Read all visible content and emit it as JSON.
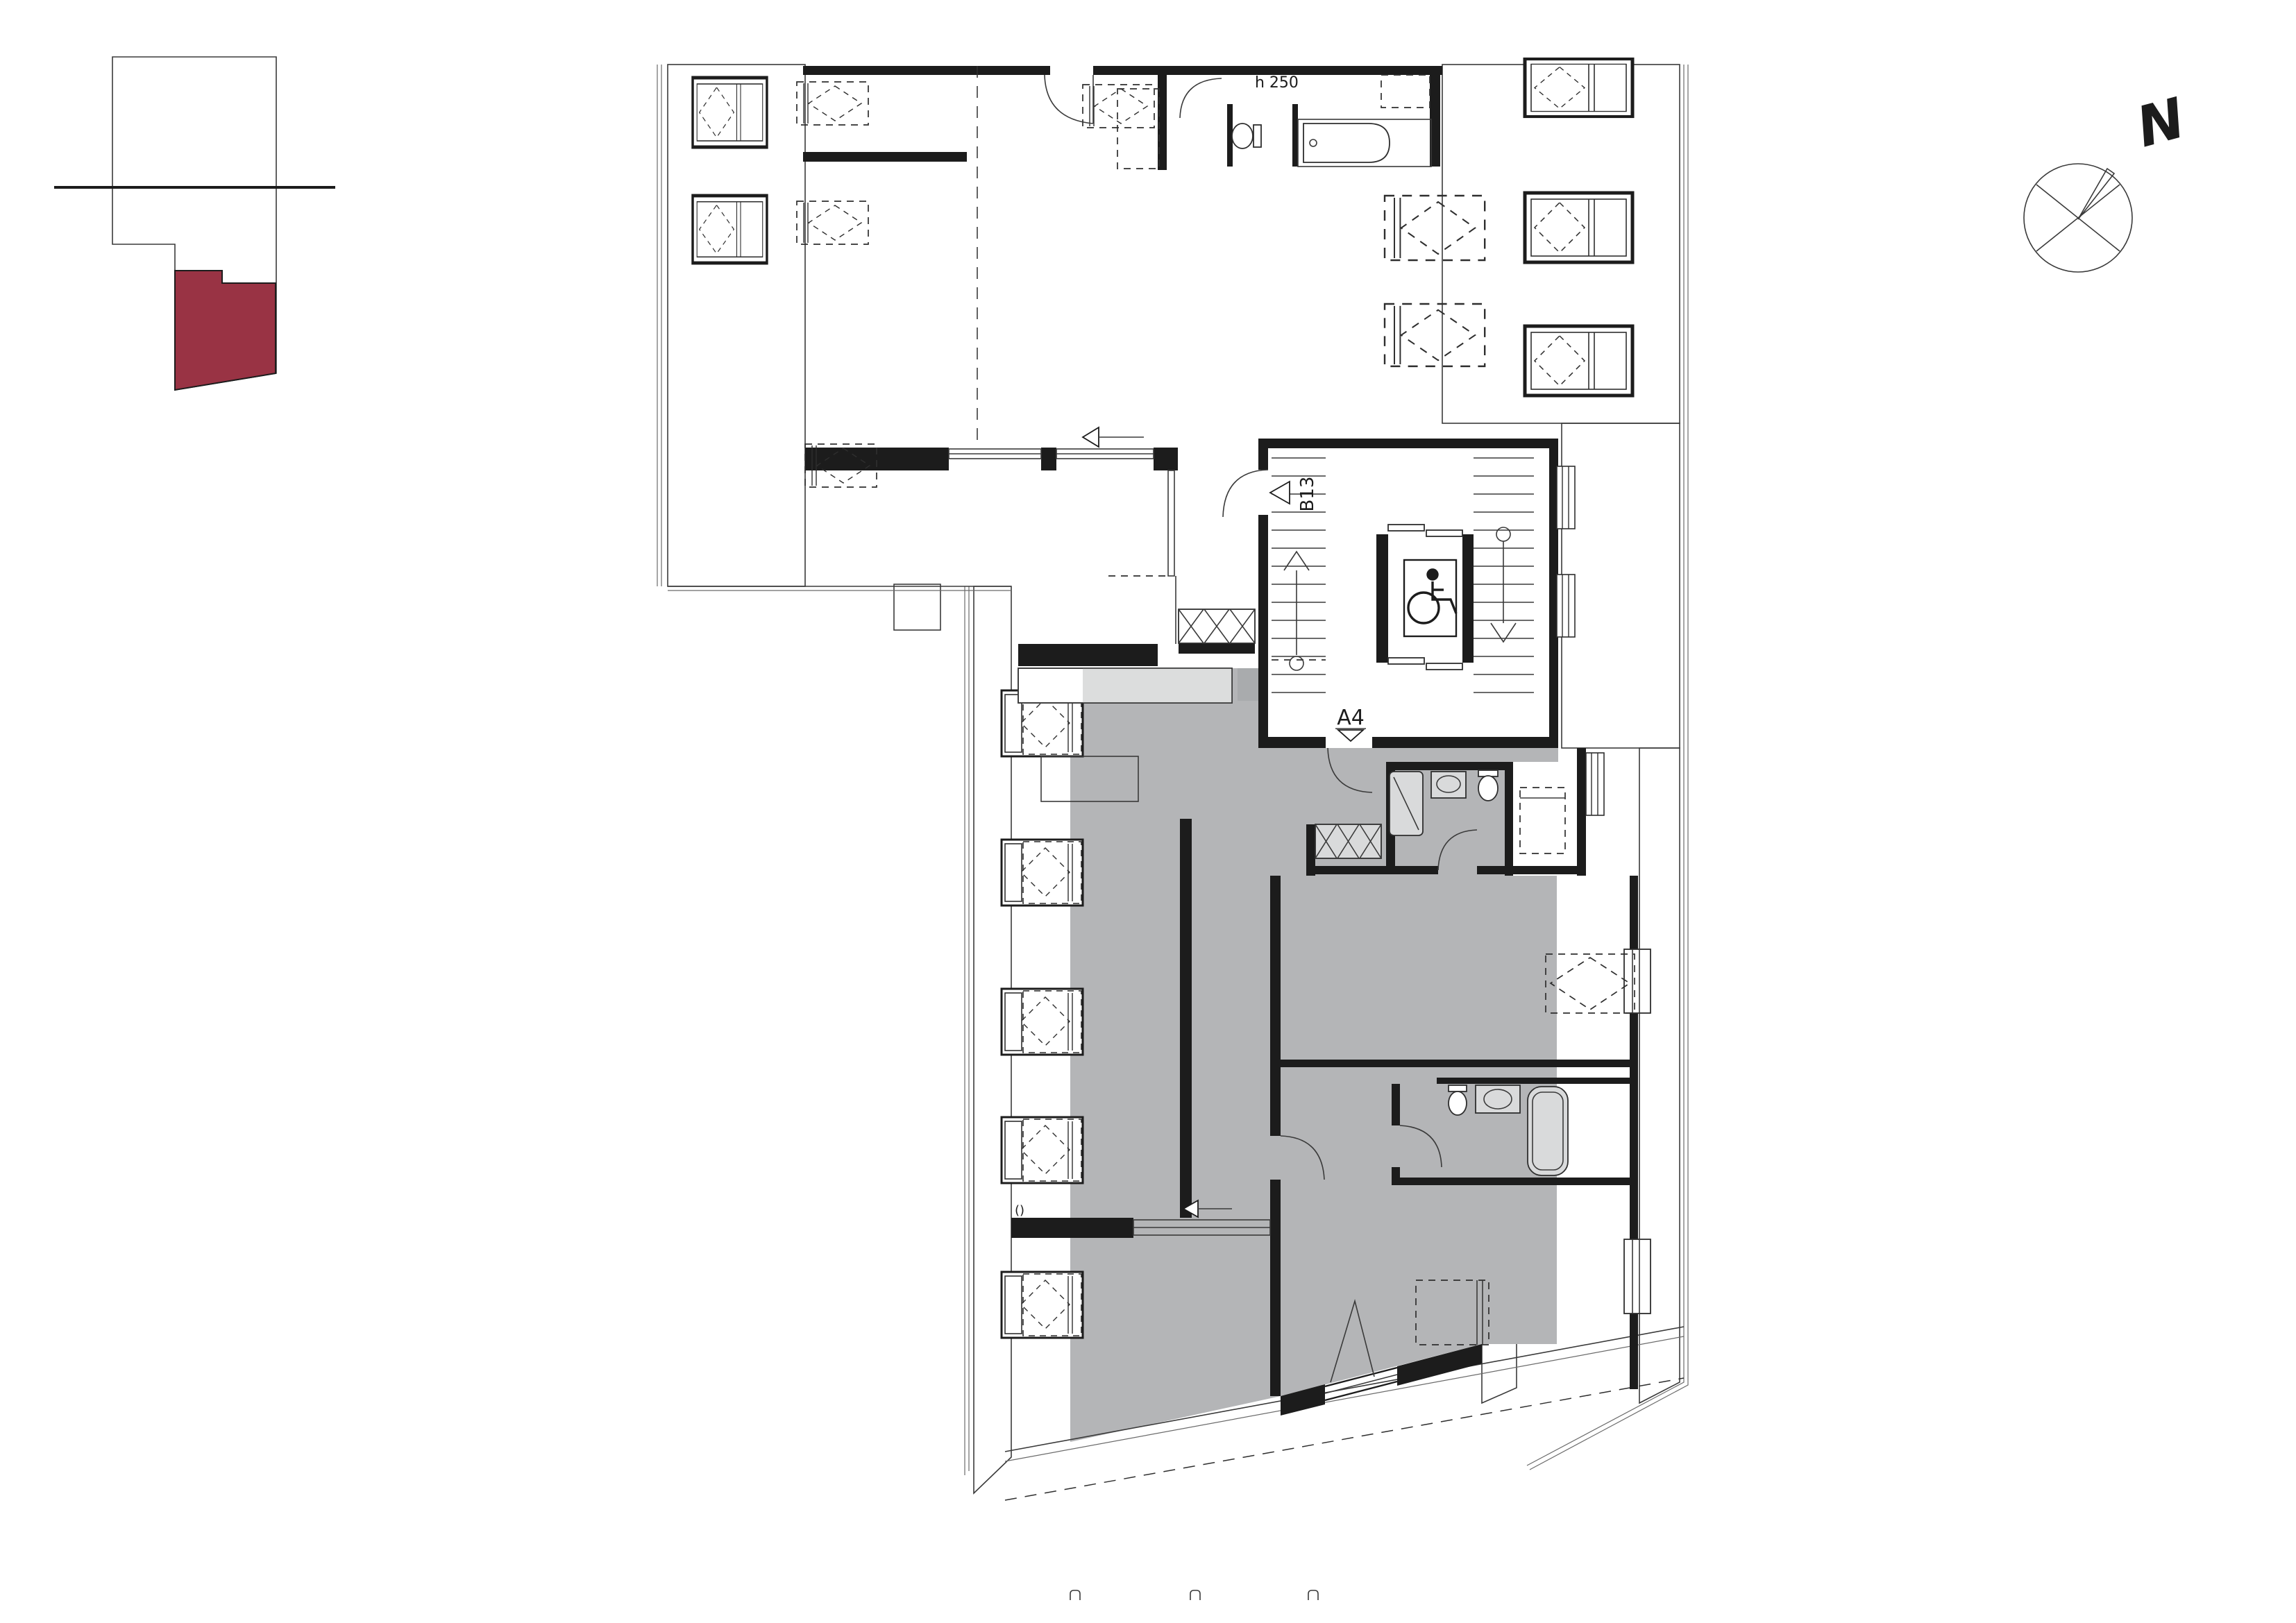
{
  "labels": {
    "north": "N",
    "height_note": "h 250",
    "entry_b13": "B13",
    "entry_a4": "A4",
    "paren_note": "()"
  },
  "colors": {
    "background": "#ffffff",
    "highlight_red": "#993344",
    "apartment_gray": "#b4b5b7",
    "fixture_gray": "#d9dadb",
    "counter_gray": "#dcdddd",
    "appliance_gray": "#a9abad",
    "wall_black": "#1c1c1c",
    "hatch_gray": "#b9b9b9"
  }
}
